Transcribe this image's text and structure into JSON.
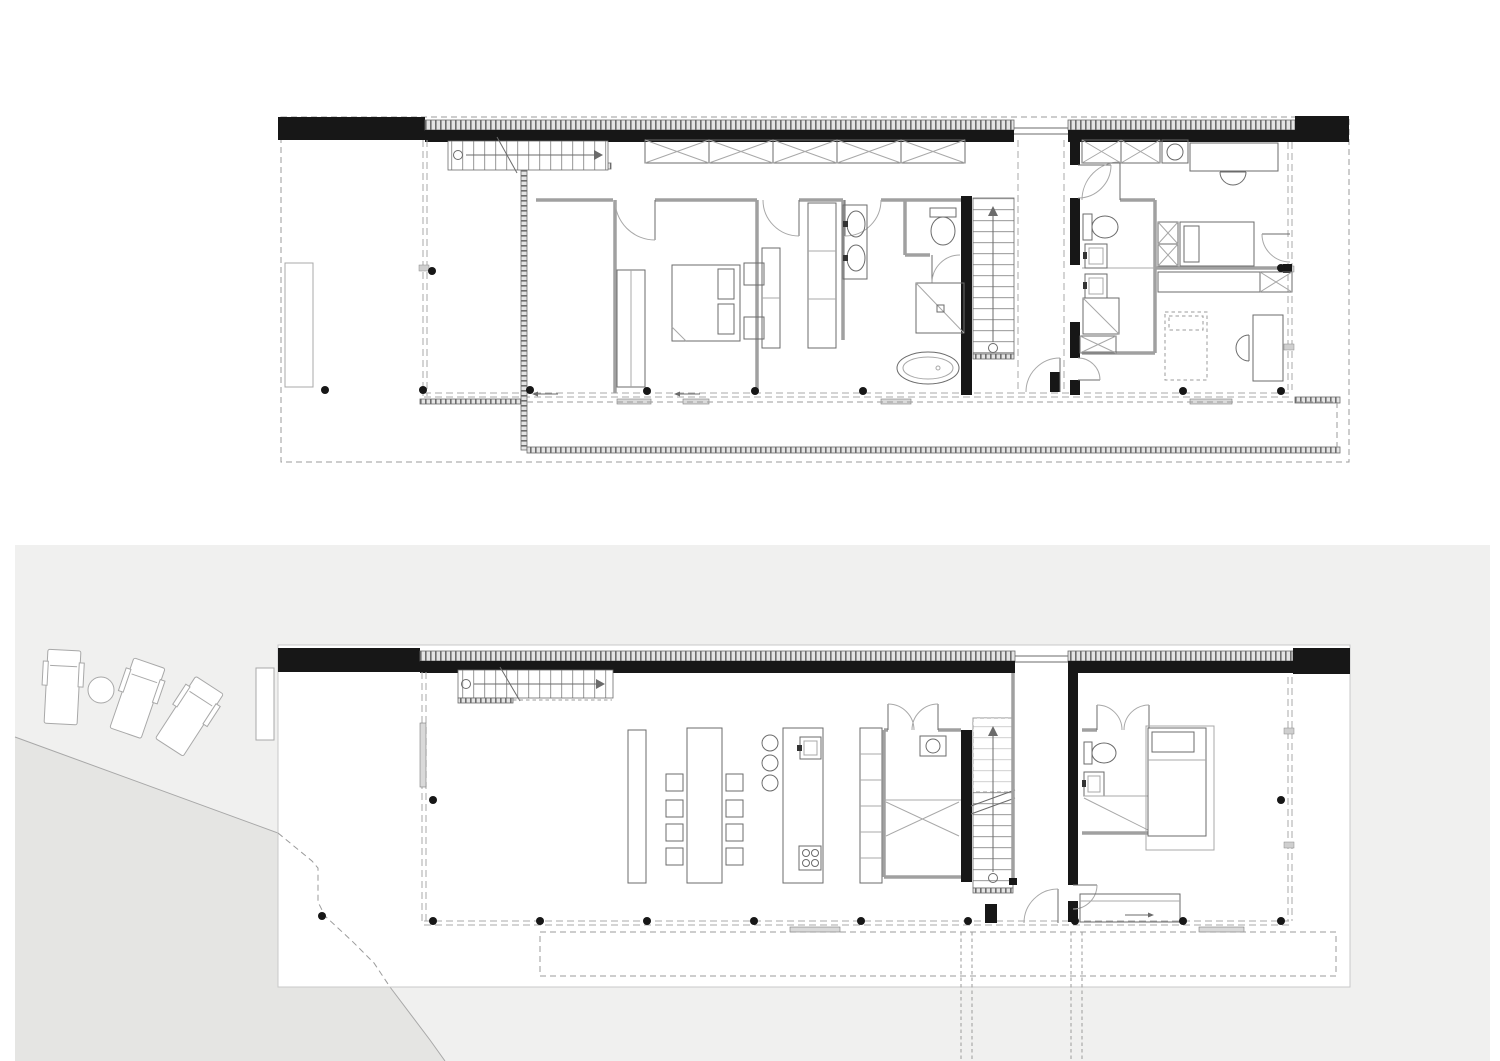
{
  "document": {
    "type": "architectural-floor-plan-sheet",
    "views": [
      {
        "id": "upper-floor-plan",
        "position": "top"
      },
      {
        "id": "ground-floor-plan-with-site",
        "position": "bottom"
      }
    ]
  },
  "colors": {
    "paper": "#ffffff",
    "site_panel": "#f0f0ef",
    "beach": "#e5e5e3",
    "wall_black": "#171717",
    "wall_gray": "#a0a0a0",
    "glazing": "#a9a9a9",
    "hatch_bg": "#e4e4e4",
    "hatch_tick": "#6e6e6e",
    "line_mid": "#6b6b6b",
    "line_light": "#a8a8a8",
    "dash": "#9b9b9b",
    "slider": "#d9d9d9",
    "plan_border": "#c9c9c9",
    "fixture_dark": "#333333"
  },
  "upper_floor": {
    "elements": [
      "roof-parapet",
      "site-outline-dashed",
      "terrace-planter",
      "stair-flight-top",
      "void-guardrail-hatch",
      "wardrobe-row-x",
      "master-bed",
      "nightstands",
      "closet-cabinets",
      "double-vanity-sinks",
      "wc-toilet",
      "shower",
      "freestanding-bathtub",
      "stair-down",
      "breezeway-link",
      "kids-bed",
      "guest-bed-dashed",
      "desk-north",
      "desk-south",
      "glass-facades",
      "structural-columns",
      "roof-deck-edge-hatch"
    ]
  },
  "ground_floor": {
    "elements": [
      "site-panel",
      "beach-slope",
      "terrain-contour",
      "sun-loungers",
      "side-table",
      "planter",
      "stair-flight",
      "dining-bench",
      "dining-table",
      "dining-chairs",
      "kitchen-island",
      "bar-stools",
      "island-sink",
      "cooktop",
      "tall-shelving",
      "pantry-room",
      "stair-up",
      "wc-toilet",
      "washbasin",
      "shower",
      "bedroom-bed",
      "window-bench",
      "terrace-deck-outline",
      "beach-path-dashed",
      "structural-columns",
      "glass-facades",
      "breezeway-entrance-door"
    ]
  },
  "counts": {
    "sun_loungers": 3,
    "dining_chairs": 8,
    "bar_stools": 3,
    "wardrobe_x_cells_upper": 5
  }
}
